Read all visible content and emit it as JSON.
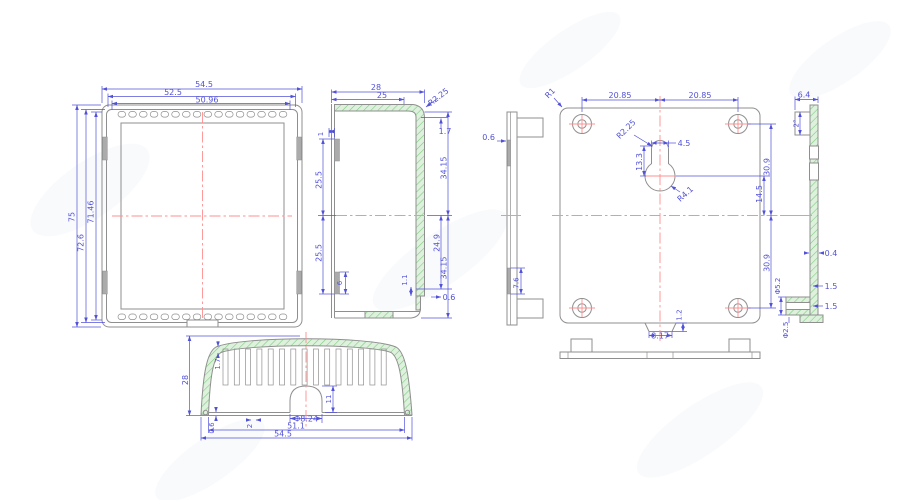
{
  "title": "enclosure-technical-drawing",
  "colors": {
    "dimension": "#5252d8",
    "outline": "#8f8f8f",
    "centerline": "#ff9090",
    "hatch_fill": "#ddf1dd",
    "hatch_stroke": "#7cc87c",
    "background": "#ffffff"
  },
  "front_view": {
    "width_outer": "54.5",
    "width_mid": "52.5",
    "width_inner": "50.96",
    "height_outer": "75",
    "height_mid": "72.6",
    "height_inner": "71.46"
  },
  "side_view": {
    "depth": "28",
    "depth_inner": "25",
    "corner_r": "R2.25",
    "wall_top": "1.7",
    "height_upper": "34.15",
    "height_inner": "24.9",
    "height_lower": "34.15",
    "clip_offset": "1",
    "half_upper": "25.5",
    "half_lower": "25.5",
    "clip_length": "6",
    "lip": "1.1",
    "gap": "0.6"
  },
  "back_view": {
    "hole_left": "20.85",
    "hole_right": "20.85",
    "corner_r": "R1",
    "key_r": "R2.25",
    "key_neck": "4.5",
    "key_len": "13.3",
    "key_big_r": "R4.1",
    "top_span": "30.9",
    "key_center": "14.5",
    "bottom_span": "30.9",
    "notch_w": "8.17",
    "notch_d": "1.2"
  },
  "back_edge_view": {
    "wall": "0.6",
    "clip": "7.6"
  },
  "section_view": {
    "tab_w": "6.4",
    "tab_h": "2°",
    "wall": "0.4",
    "step_a": "1.5",
    "step_b": "1.5",
    "boss_od": "Φ5.2",
    "boss_id": "Φ2.5"
  },
  "bottom_view": {
    "height": "28",
    "fin_wall": "1.7",
    "dome_h": "11",
    "dome_d": "Φ8.24",
    "rib": "2",
    "base": "0.6",
    "width_inner": "51.1",
    "width_outer": "54.5"
  }
}
